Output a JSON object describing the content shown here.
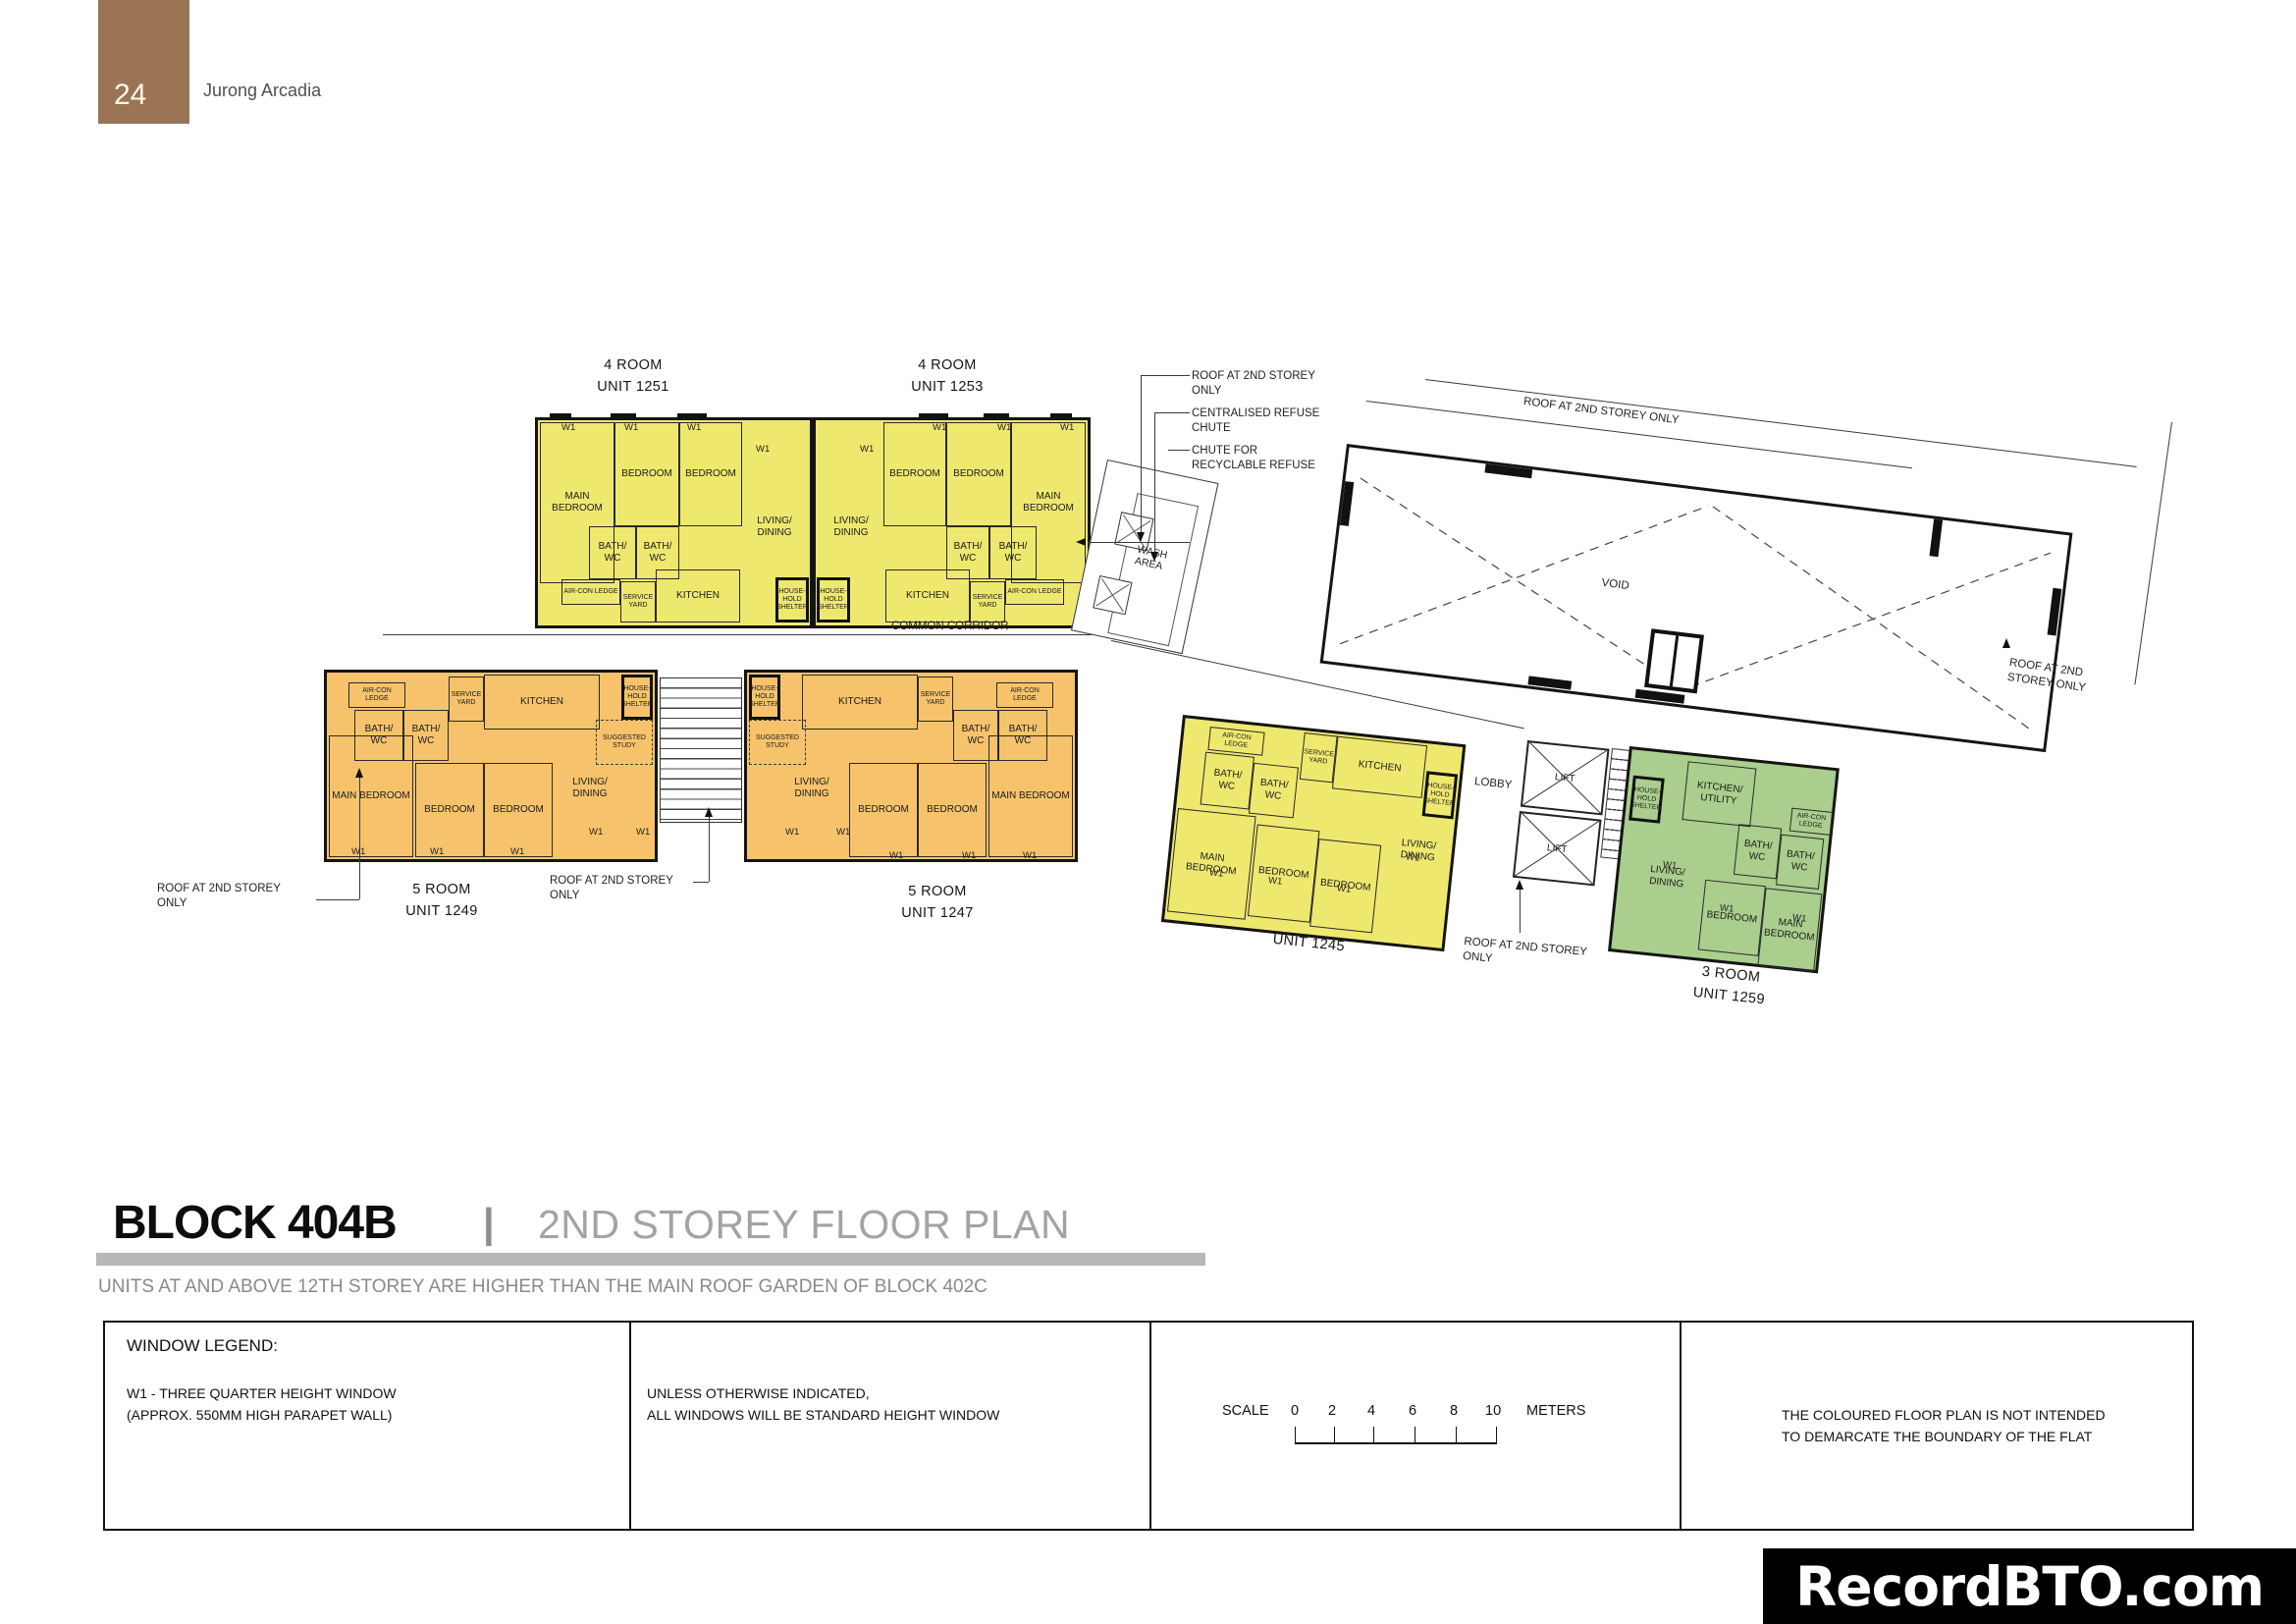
{
  "header": {
    "page_number": "24",
    "project": "Jurong Arcadia"
  },
  "colors": {
    "four_room_yellow": "#EFE86F",
    "five_room_orange": "#F6C36C",
    "three_room_green": "#A9CE8D",
    "header_brown": "#9B7456",
    "title_gray": "#A3A3A3",
    "bar_gray": "#B8B8B8",
    "watermark_bg": "#000000"
  },
  "labels": {
    "w1": "W1",
    "common_corridor": "COMMON CORRIDOR",
    "void": "VOID",
    "lobby": "LOBBY",
    "lift": "LIFT",
    "wash_area": "WASH AREA"
  },
  "annotations": {
    "roof_two_line": [
      "ROOF AT 2ND STOREY",
      "ONLY"
    ],
    "roof_stacked": [
      "ROOF AT 2ND",
      "STOREY ONLY"
    ],
    "roof_single": "ROOF AT 2ND STOREY ONLY",
    "centralised": [
      "CENTRALISED REFUSE",
      "CHUTE"
    ],
    "recyclable": [
      "CHUTE FOR",
      "RECYCLABLE REFUSE"
    ]
  },
  "units": [
    {
      "type": "4 ROOM",
      "unit": "UNIT 1251",
      "rooms": [
        "MAIN BEDROOM",
        "BEDROOM",
        "BEDROOM",
        "LIVING/ DINING",
        "BATH/ WC",
        "BATH/ WC",
        "AIR-CON LEDGE",
        "SERVICE YARD",
        "KITCHEN",
        "HOUSE- HOLD SHELTER"
      ]
    },
    {
      "type": "4 ROOM",
      "unit": "UNIT 1253",
      "rooms": [
        "MAIN BEDROOM",
        "BEDROOM",
        "BEDROOM",
        "LIVING/ DINING",
        "BATH/ WC",
        "BATH/ WC",
        "AIR-CON LEDGE",
        "SERVICE YARD",
        "KITCHEN",
        "HOUSE- HOLD SHELTER"
      ]
    },
    {
      "type": "5 ROOM",
      "unit": "UNIT 1249",
      "rooms": [
        "MAIN BEDROOM",
        "BEDROOM",
        "BEDROOM",
        "LIVING/ DINING",
        "SUGGESTED STUDY",
        "BATH/ WC",
        "BATH/ WC",
        "AIR-CON LEDGE",
        "SERVICE YARD",
        "KITCHEN",
        "HOUSE- HOLD SHELTER"
      ]
    },
    {
      "type": "5 ROOM",
      "unit": "UNIT 1247",
      "rooms": [
        "MAIN BEDROOM",
        "BEDROOM",
        "BEDROOM",
        "LIVING/ DINING",
        "SUGGESTED STUDY",
        "BATH/ WC",
        "BATH/ WC",
        "AIR-CON LEDGE",
        "SERVICE YARD",
        "KITCHEN",
        "HOUSE- HOLD SHELTER"
      ]
    },
    {
      "type": "4 ROOM",
      "unit": "UNIT 1245",
      "rooms": [
        "MAIN BEDROOM",
        "BEDROOM",
        "BEDROOM",
        "LIVING/ DINING",
        "BATH/ WC",
        "BATH/ WC",
        "AIR-CON LEDGE",
        "SERVICE YARD",
        "KITCHEN",
        "HOUSE- HOLD SHELTER"
      ]
    },
    {
      "type": "3 ROOM",
      "unit": "UNIT 1259",
      "rooms": [
        "LIVING/ DINING",
        "BEDROOM",
        "MAIN BEDROOM",
        "KITCHEN/ UTILITY",
        "BATH/ WC",
        "BATH/ WC",
        "AIR-CON LEDGE",
        "HOUSE- HOLD SHELTER"
      ]
    }
  ],
  "section": {
    "block": "BLOCK 404B",
    "separator": "|",
    "plan_title": "2ND STOREY FLOOR PLAN",
    "note": "UNITS AT AND ABOVE 12TH STOREY ARE HIGHER THAN THE MAIN ROOF GARDEN OF BLOCK 402C"
  },
  "legend": {
    "window_legend_title": "WINDOW LEGEND:",
    "w1_lines": [
      "W1 - THREE QUARTER HEIGHT WINDOW",
      "(APPROX. 550MM HIGH PARAPET WALL)"
    ],
    "window_note_lines": [
      "UNLESS OTHERWISE INDICATED,",
      "ALL WINDOWS WILL BE STANDARD HEIGHT WINDOW"
    ],
    "scale_label": "SCALE",
    "scale_ticks": [
      "0",
      "2",
      "4",
      "6",
      "8",
      "10"
    ],
    "scale_unit": "METERS",
    "disclaimer_lines": [
      "THE COLOURED FLOOR PLAN IS NOT INTENDED",
      "TO DEMARCATE THE BOUNDARY OF THE FLAT"
    ]
  },
  "watermark": "RecordBTO.com"
}
